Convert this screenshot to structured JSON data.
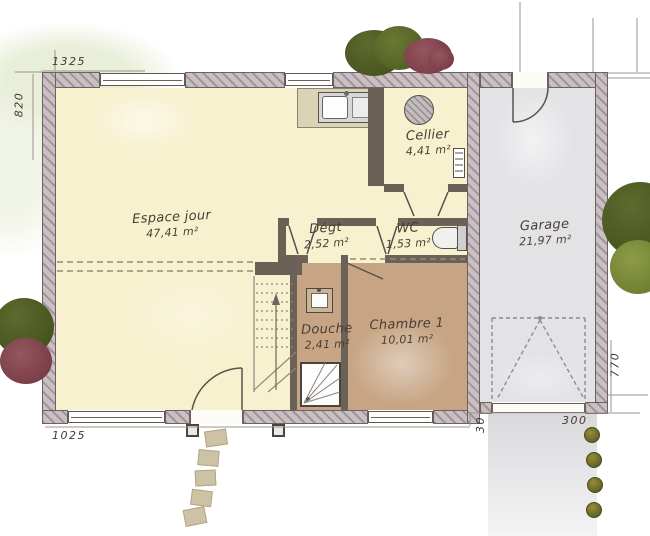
{
  "plan_title": "Floor plan - ground floor",
  "rooms": [
    {
      "name": "Espace jour",
      "area": "47,41 m²"
    },
    {
      "name": "Cellier",
      "area": "4,41 m²"
    },
    {
      "name": "Dégt",
      "area": "2,52 m²"
    },
    {
      "name": "WC",
      "area": "1,53 m²"
    },
    {
      "name": "Douche",
      "area": "2,41 m²"
    },
    {
      "name": "Chambre 1",
      "area": "10,01 m²"
    },
    {
      "name": "Garage",
      "area": "21,97 m²"
    }
  ],
  "dims": {
    "top_width": "1325",
    "left_height": "820",
    "bottom_width": "1025",
    "garage_offset": "30",
    "garage_door_width": "300",
    "garage_depth": "770"
  },
  "fixtures": [
    "kitchen-sink",
    "water-heater",
    "electrical-panel",
    "toilet",
    "washbasin",
    "shower-tray",
    "staircase",
    "entry-door",
    "garage-service-door",
    "garage-up-and-over-door",
    "porch-posts",
    "stepping-stones"
  ],
  "colors": {
    "living_floor": "#f7f1cf",
    "bedroom_floor": "#c7a584",
    "garage_floor": "#e3e3e6",
    "exterior_wall": "#cac0c4",
    "interior_wall": "#6b6156",
    "counter": "#dcd2b6",
    "foliage_dark": "#46531f",
    "foliage_light": "#7c8d3a",
    "flower_bush": "#82414c",
    "ink": "#473f35"
  }
}
